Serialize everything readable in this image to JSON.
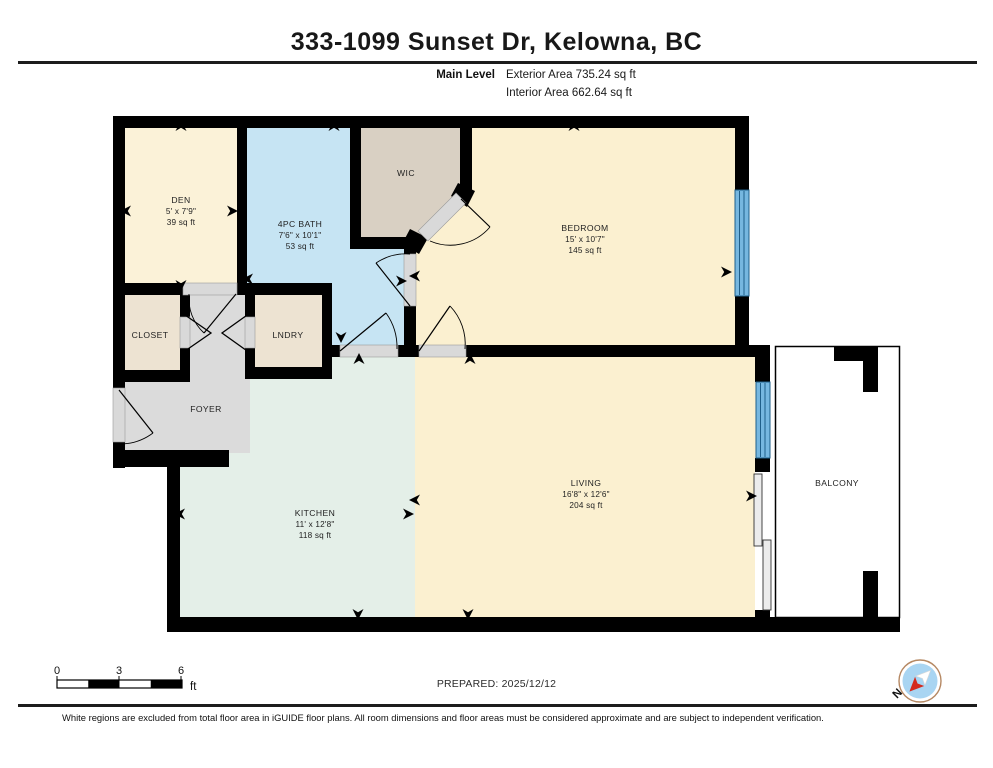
{
  "header": {
    "title": "333-1099 Sunset Dr, Kelowna, BC",
    "level_label": "Main Level",
    "exterior_area": "Exterior Area 735.24 sq ft",
    "interior_area": "Interior Area 662.64 sq ft"
  },
  "rooms": {
    "den": {
      "name": "DEN",
      "dims": "5' x 7'9\"",
      "area": "39 sq ft"
    },
    "bath": {
      "name": "4PC BATH",
      "dims": "7'6\" x 10'1\"",
      "area": "53 sq ft"
    },
    "wic": {
      "name": "WIC"
    },
    "bedroom": {
      "name": "BEDROOM",
      "dims": "15' x 10'7\"",
      "area": "145 sq ft"
    },
    "closet": {
      "name": "CLOSET"
    },
    "laundry": {
      "name": "LNDRY"
    },
    "foyer": {
      "name": "FOYER"
    },
    "kitchen": {
      "name": "KITCHEN",
      "dims": "11' x 12'8\"",
      "area": "118 sq ft"
    },
    "living": {
      "name": "LIVING",
      "dims": "16'8\" x 12'6\"",
      "area": "204 sq ft"
    },
    "balcony": {
      "name": "BALCONY"
    }
  },
  "scale_bar": {
    "tick0": "0",
    "tick1": "3",
    "tick2": "6",
    "unit": "ft"
  },
  "prepared": "PREPARED: 2025/12/12",
  "compass": {
    "north_label": "N"
  },
  "disclaimer": "White regions are excluded from total floor area in iGUIDE floor plans. All room dimensions and floor areas must be considered approximate and are subject to independent verification.",
  "palette": {
    "wall": "#000000",
    "den": "#FBF2D8",
    "bath": "#C6E4F3",
    "wic": "#D9D0C3",
    "bedroom": "#FBF0D0",
    "closet_laundry": "#EDE3D2",
    "foyer": "#DBDBDB",
    "kitchen": "#E4EFE8",
    "living": "#FBF0D0",
    "balcony": "#FFFFFF",
    "window": "#76B7E0",
    "door": "#D9D9D9"
  }
}
